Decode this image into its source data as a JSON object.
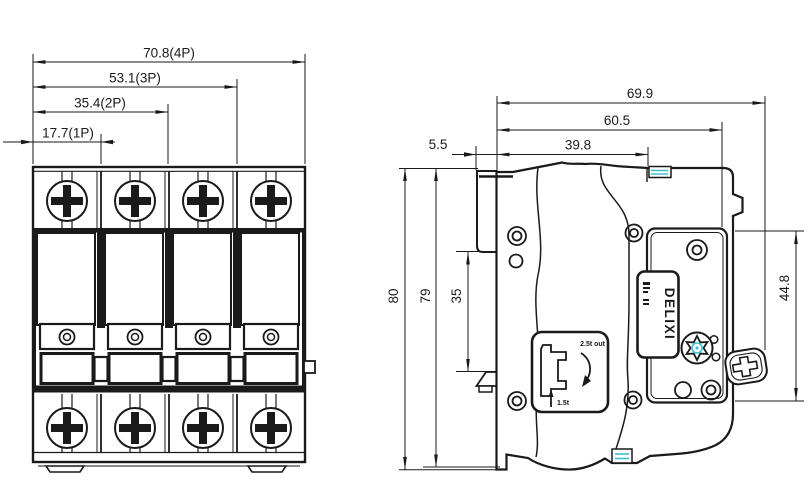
{
  "drawing": {
    "front_view": {
      "dim_4p": "70.8(4P)",
      "dim_3p": "53.1(3P)",
      "dim_2p": "35.4(2P)",
      "dim_1p": "17.7(1P)"
    },
    "side_view": {
      "dim_width_total": "69.9",
      "dim_width_face": "60.5",
      "dim_width_body": "39.8",
      "dim_rail_tab": "5.5",
      "dim_height_total": "80",
      "dim_height_body": "79",
      "dim_rail_slot": "35",
      "dim_face_height": "44.8",
      "brand": "DELIXI",
      "emblem_top": "2.5t out",
      "emblem_bottom": "1.5t"
    },
    "colors": {
      "line": "#1a1a1a",
      "accent": "#3fc0cc"
    }
  }
}
